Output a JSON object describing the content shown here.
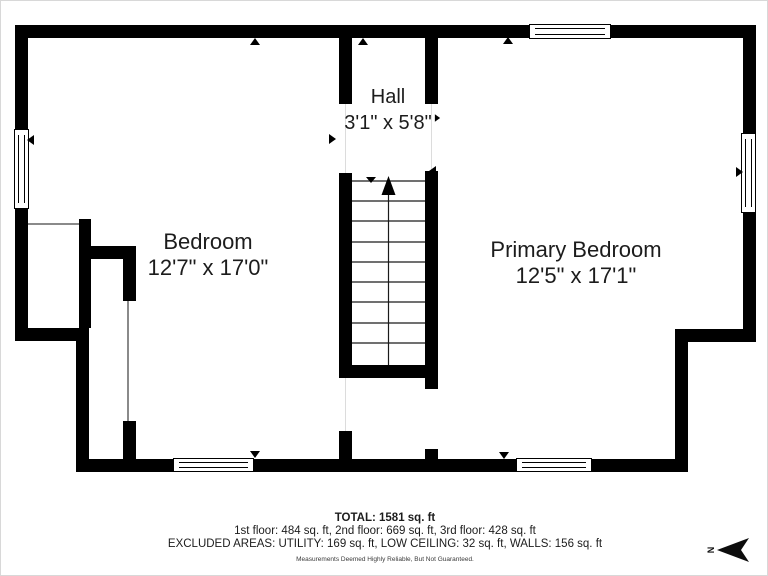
{
  "rooms": {
    "hall": {
      "name": "Hall",
      "dims": "3'1\" x 5'8\""
    },
    "bedroom": {
      "name": "Bedroom",
      "dims": "12'7\" x 17'0\""
    },
    "primary": {
      "name": "Primary Bedroom",
      "dims": "12'5\" x 17'1\""
    }
  },
  "footer": {
    "total": "TOTAL: 1581 sq. ft",
    "floors": "1st floor: 484 sq. ft, 2nd floor: 669 sq. ft, 3rd floor: 428 sq. ft",
    "excluded": "EXCLUDED AREAS: UTILITY: 169 sq. ft, LOW CEILING: 32 sq. ft, WALLS: 156 sq. ft",
    "disclaimer": "Measurements Deemed Highly Reliable, But Not Guaranteed."
  },
  "compass": {
    "north_label": "N"
  },
  "colors": {
    "wall": "#000000",
    "background": "#ffffff",
    "text": "#1c1c1c",
    "muted": "#3a3a3a"
  }
}
